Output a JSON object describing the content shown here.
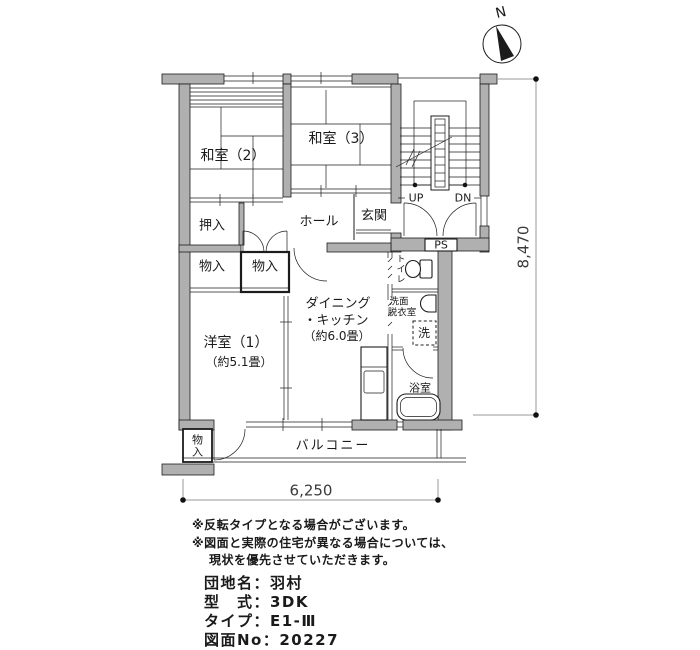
{
  "colors": {
    "background": "#ffffff",
    "wall_fill": "#b0b0b0",
    "line": "#1c1c1c",
    "dim_line": "#9a9a9a",
    "text": "#1a1a1a"
  },
  "compass": {
    "label": "N"
  },
  "plan": {
    "labels": {
      "washitsu2": "和室（2）",
      "washitsu3": "和室（3）",
      "oshiire": "押入",
      "monoire_west": "物入",
      "monoire_hall": "物入",
      "hall": "ホール",
      "genkan": "玄関",
      "western1": "洋室（1）",
      "western1_size": "（約5.1畳）",
      "dk_line1": "ダイニング",
      "dk_line2": "・キッチン",
      "dk_size": "（約6.0畳）",
      "toilet": "トイレ",
      "senmen_line1": "洗面",
      "senmen_line2": "脱衣室",
      "washer": "洗",
      "bath": "浴室",
      "ps": "PS",
      "up": "UP",
      "dn": "DN",
      "balcony": "バルコニー",
      "balcony_storage": "物入"
    }
  },
  "dimensions": {
    "right": "8,470",
    "bottom": "6,250"
  },
  "notes": {
    "line1": "※反転タイプとなる場合がございます。",
    "line2": "※図面と実際の住宅が異なる場合については、",
    "line3": "現状を優先させていただきます。"
  },
  "info": {
    "line1": "団地名：羽村",
    "line2": "型　式：3DK",
    "line3": "タイプ：E1-Ⅲ",
    "line4": "図面No：20227"
  }
}
